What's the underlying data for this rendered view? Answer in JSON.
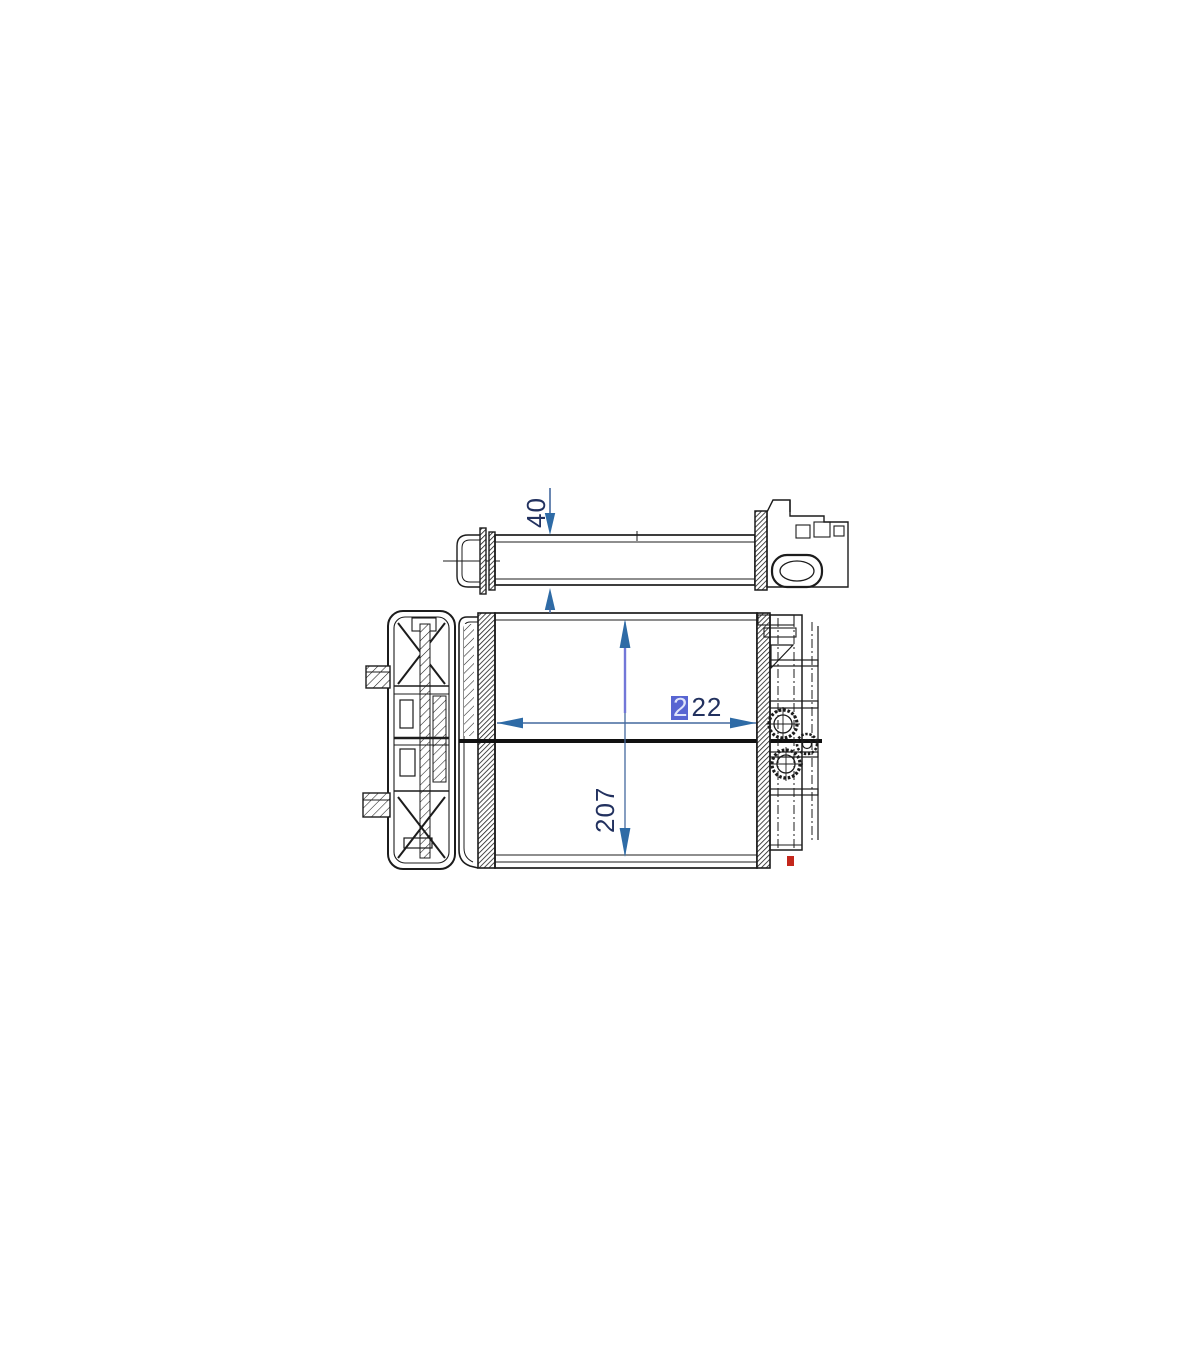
{
  "drawing": {
    "dim_depth": {
      "value": "40"
    },
    "dim_width": {
      "value": "222",
      "first_digit": "2",
      "rest": "22"
    },
    "dim_height": {
      "value": "207"
    },
    "colors": {
      "line": "#1c1c1c",
      "dimension_line": "#44699e",
      "dimension_line_upper": "#7277d8",
      "arrow": "#2e6ba6",
      "dimension_text": "#22315f",
      "highlight": "#5865d2",
      "highlight_text": "#dfe4fa",
      "red_mark": "#c4271c",
      "background": "#ffffff"
    }
  }
}
